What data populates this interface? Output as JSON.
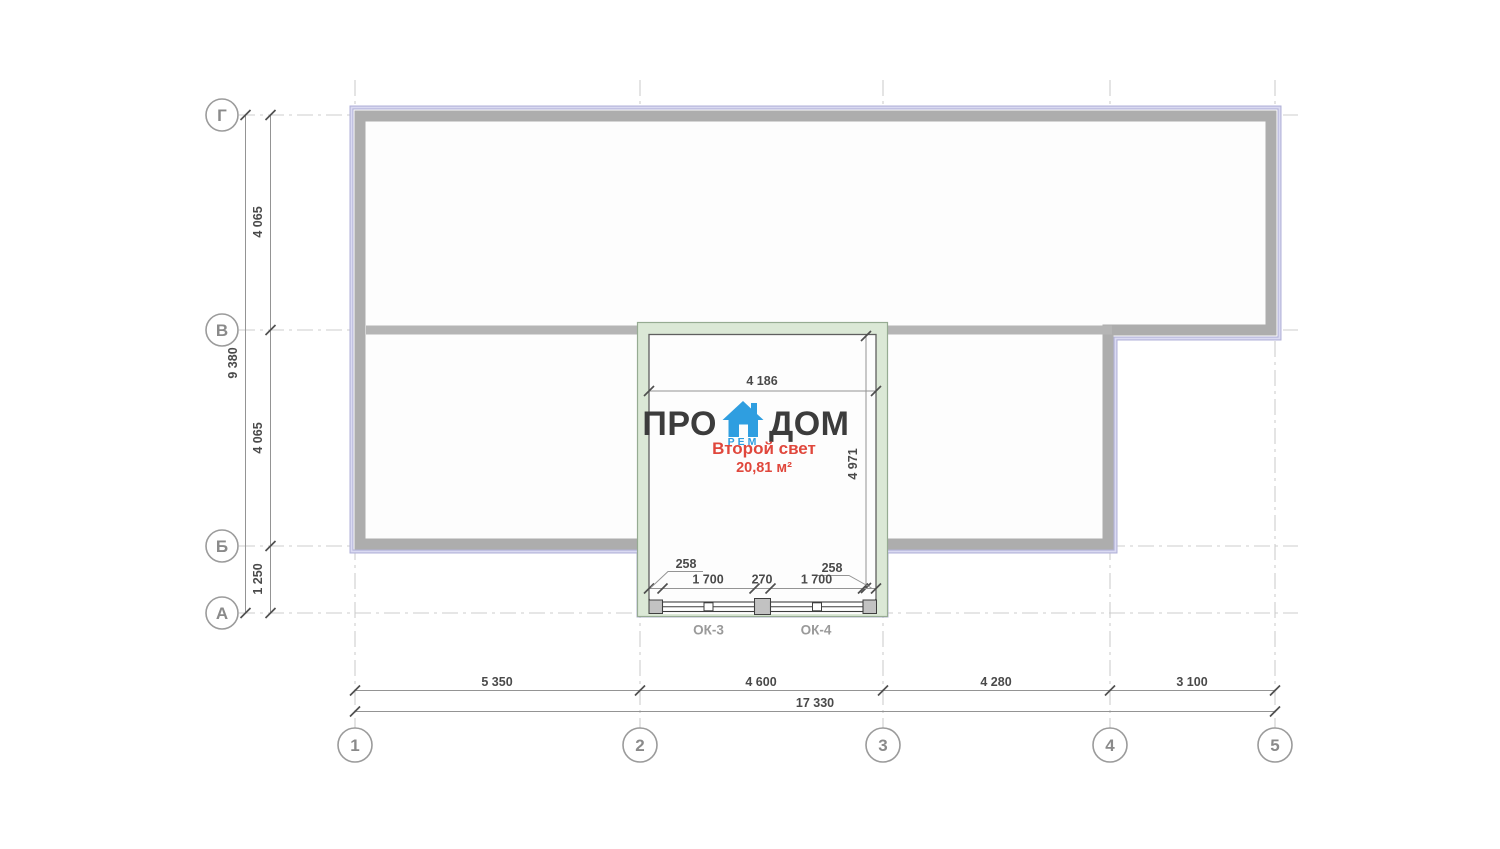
{
  "plan": {
    "logo": {
      "word1": "ПРО",
      "word2": "ДОМ",
      "sub": "РЕМ"
    },
    "room": {
      "name": "Второй свет",
      "area": "20,81 м²"
    },
    "grid": {
      "rows": [
        {
          "label": "Г"
        },
        {
          "label": "В"
        },
        {
          "label": "Б"
        },
        {
          "label": "А"
        }
      ],
      "cols": [
        {
          "label": "1"
        },
        {
          "label": "2"
        },
        {
          "label": "3"
        },
        {
          "label": "4"
        },
        {
          "label": "5"
        }
      ]
    },
    "dims": {
      "left_segments": [
        "4 065",
        "4 065",
        "1 250"
      ],
      "left_total": "9 380",
      "bottom_segments": [
        "5 350",
        "4 600",
        "4 280",
        "3 100"
      ],
      "bottom_total": "17 330",
      "room_width": "4 186",
      "room_height": "4 971",
      "window_edge_left": "258",
      "window_edge_right": "258",
      "window_segments": [
        "1 700",
        "270",
        "1 700"
      ]
    },
    "windows": [
      {
        "label": "ОК-3"
      },
      {
        "label": "ОК-4"
      }
    ],
    "colors": {
      "wall_fill": "#adadad",
      "wall_outline": "#b2b2d8",
      "room_wall_fill": "#dbe8d6",
      "accent_blue": "#2f9ee0",
      "accent_red": "#e0473c",
      "text_dark": "#3c3c3c",
      "dim_text": "#4a4a4a",
      "grid_line": "#cdcdcd",
      "bubble": "#8a8a8a"
    }
  }
}
